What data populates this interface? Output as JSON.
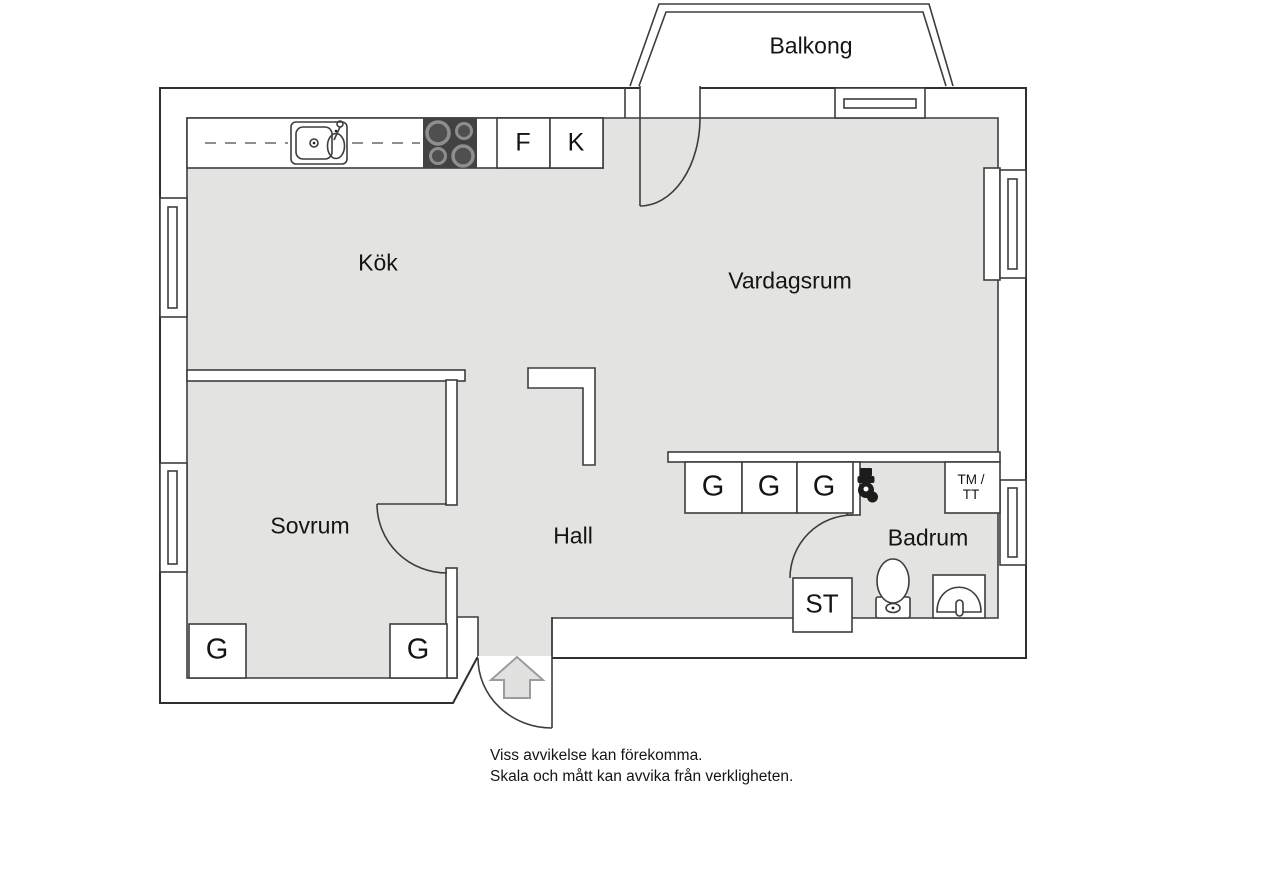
{
  "plan": {
    "rooms": {
      "balcony": "Balkong",
      "kitchen": "Kök",
      "living_room": "Vardagsrum",
      "bedroom": "Sovrum",
      "hall": "Hall",
      "bathroom": "Badrum"
    },
    "cabinets": {
      "fridge": "F",
      "freezer": "K",
      "cleaning": "ST",
      "laundry_line1": "TM /",
      "laundry_line2": "TT",
      "wardrobes_hall": [
        "G",
        "G",
        "G"
      ],
      "wardrobes_bedroom": [
        "G",
        "G"
      ]
    },
    "disclaimer": {
      "line1": "Viss avvikelse kan förekomma.",
      "line2": "Skala och mått kan avvika från verkligheten."
    },
    "colors": {
      "floor": "#e3e3e1",
      "line": "#3d3d3d",
      "stove": "#424242",
      "burner_ring": "#8e8e8e",
      "burner_center": "#4f4f4f",
      "fixture": "#1c1c1c",
      "arrow_fill": "#e1e1df",
      "arrow_stroke": "#9b9b9b"
    }
  }
}
